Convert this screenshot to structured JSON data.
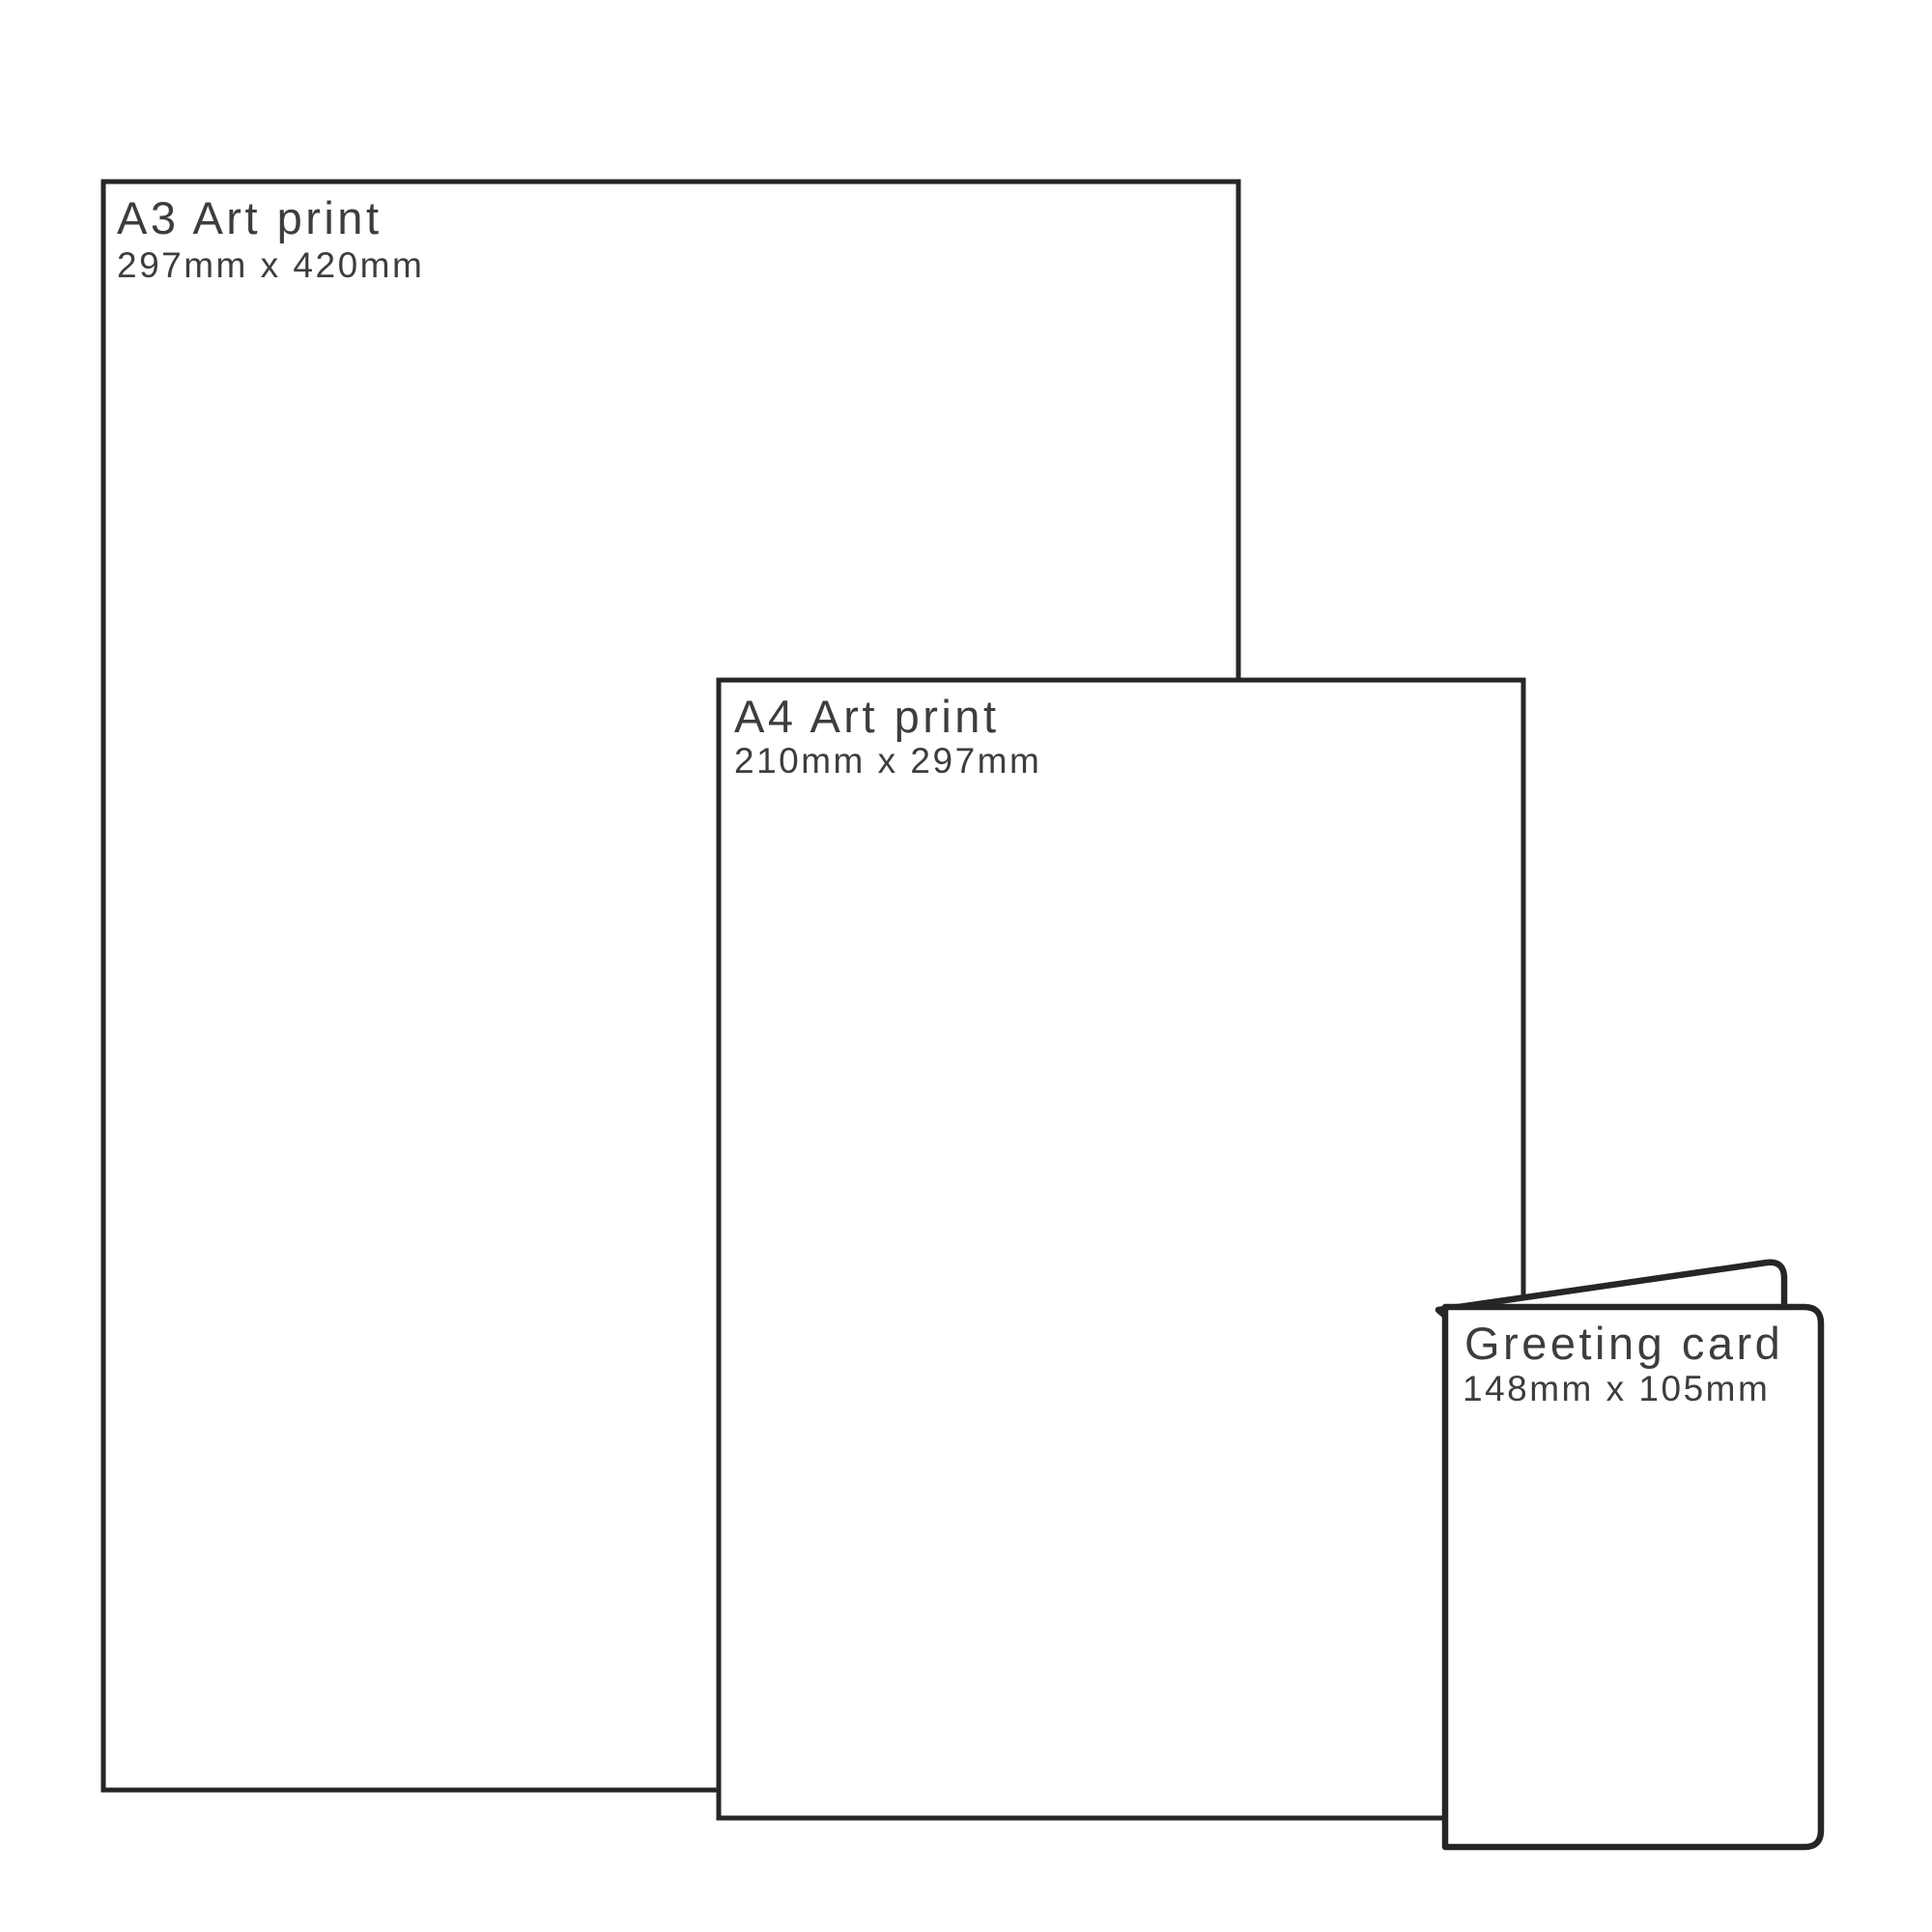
{
  "diagram": {
    "background": "#ffffff",
    "outline_color": "#262626",
    "text_color": "#3d3d3d",
    "products": [
      {
        "title": "A3 Art print",
        "dimensions": "297mm x 420mm"
      },
      {
        "title": "A4 Art print",
        "dimensions": "210mm x 297mm"
      },
      {
        "title": "Greeting card",
        "dimensions": "148mm x 105mm"
      }
    ]
  }
}
